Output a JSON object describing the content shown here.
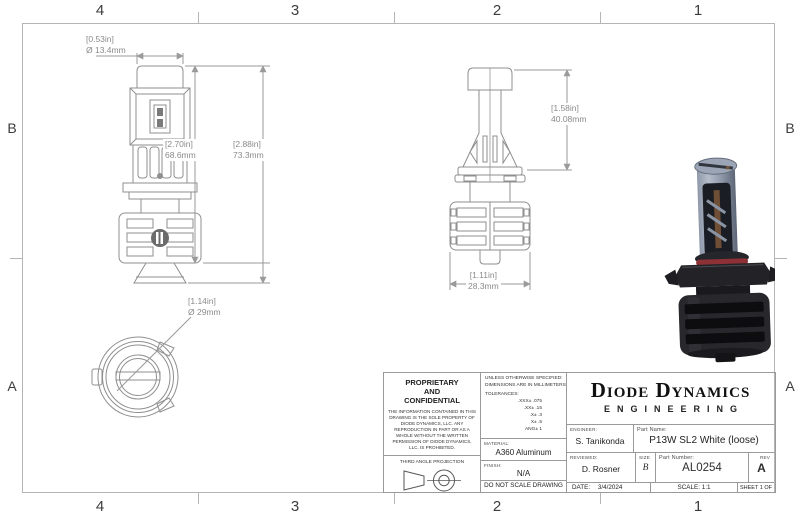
{
  "sheet": {
    "zones": {
      "columns": [
        "4",
        "3",
        "2",
        "1"
      ],
      "rows": [
        "B",
        "A"
      ]
    }
  },
  "dimensions": {
    "cap_diameter": {
      "inches": "[0.53in]",
      "metric": "Ø 13.4mm"
    },
    "body_height": {
      "inches": "[2.70in]",
      "metric": "68.6mm"
    },
    "overall_height": {
      "inches": "[2.88in]",
      "metric": "73.3mm"
    },
    "upper_section_height": {
      "inches": "[1.58in]",
      "metric": "40.08mm"
    },
    "heatsink_width": {
      "inches": "[1.11in]",
      "metric": "28.3mm"
    },
    "base_diameter": {
      "inches": "[1.14in]",
      "metric": "Ø 29mm"
    }
  },
  "title_block": {
    "proprietary": {
      "heading": [
        "PROPRIETARY",
        "AND",
        "CONFIDENTIAL"
      ],
      "body": "THE INFORMATION CONTAINED IN THIS DRAWING IS THE SOLE PROPERTY OF DIODE DYNAMICS, LLC.  ANY REPRODUCTION IN PART OR AS A WHOLE WITHOUT THE WRITTEN PERMISSION OF DIODE DYNAMICS, LLC. IS PROHIBITED.",
      "projection": "THIRD ANGLE PROJECTION"
    },
    "specs": {
      "unless": "UNLESS OTHERWISE SPECIFIED:",
      "units": "DIMENSIONS ARE IN MILLIMETERS",
      "tolerances_label": "TOLERANCES:",
      "tolerances": [
        ".XXX± .075",
        ".XX± .15",
        ".X± .3",
        "X± .5",
        "ANG± 1"
      ],
      "material_label": "MATERIAL:",
      "material": "A360 Aluminum",
      "finish_label": "FINISH:",
      "finish": "N/A",
      "do_not_scale": "DO NOT SCALE DRAWING"
    },
    "company": {
      "name": "Diode Dynamics",
      "division": "ENGINEERING"
    },
    "fields": {
      "engineer_label": "ENGINEER:",
      "engineer": "S. Tanikonda",
      "part_name_label": "Part Name:",
      "part_name": "P13W SL2 White (loose)",
      "reviewed_label": "REVIEWED:",
      "reviewed": "D. Rosner",
      "size_label": "SIZE",
      "size": "B",
      "part_number_label": "Part Number:",
      "part_number": "AL0254",
      "rev_label": "REV",
      "rev": "A",
      "date_label": "DATE:",
      "date": "3/4/2024",
      "scale": "SCALE: 1:1",
      "sheet": "SHEET 1 OF 1"
    }
  },
  "colors": {
    "drawing_line": "#8f8f8f",
    "frame_line": "#b5b5b5",
    "dimension_text": "#8a8a8a",
    "render_heatsink": "#26262b",
    "render_cap": "#9ba5b5",
    "render_oring": "#8e3136"
  }
}
